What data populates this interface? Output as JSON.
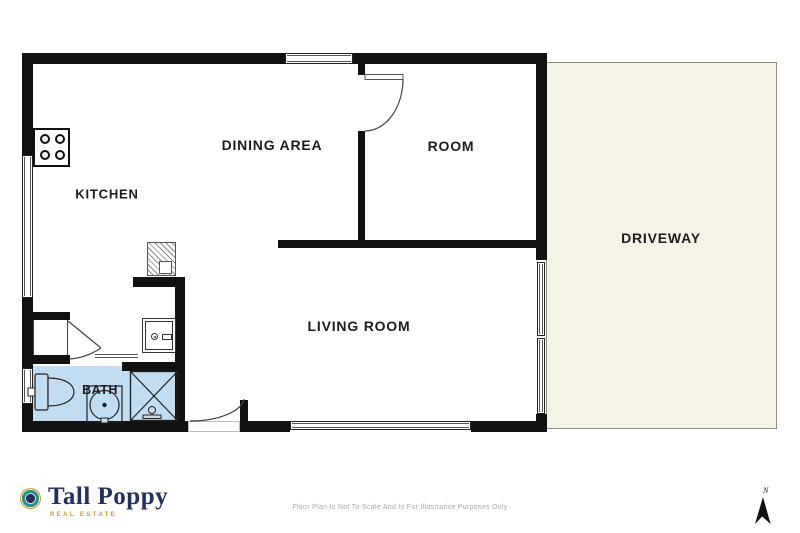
{
  "page": {
    "type": "residential-floor-plan"
  },
  "rooms": {
    "kitchen": "KITCHEN",
    "dining_area": "DINING AREA",
    "room": "ROOM",
    "living_room": "LIVING ROOM",
    "bath": "BATH",
    "driveway": "DRIVEWAY"
  },
  "branding": {
    "name": "Tall Poppy",
    "tagline": "REAL ESTATE"
  },
  "compass": {
    "north": "N"
  },
  "footer": {
    "disclaimer": "Floor Plan Is Not To Scale And Is For Illustrative Purposes Only"
  },
  "colors": {
    "wall": "#111111",
    "bath-fill": "#c2ddf1",
    "driveway-fill": "#f5f3e6",
    "driveway-border": "#8e8e7e",
    "label": "#1c1c1c",
    "brand-navy": "#25305f",
    "brand-gold": "#c79a35",
    "brand-teal": "#2e8f8a",
    "disclaimer": "#a8a8a8"
  },
  "icons": {
    "logo_mark": "tall-poppy-logo-icon",
    "north_arrow": "north-arrow-icon",
    "stove": "stove-icon",
    "hot_water_cylinder": "hot-water-cylinder-icon",
    "washing_machine": "washing-machine-icon",
    "toilet": "toilet-icon",
    "basin": "basin-icon",
    "shower": "shower-icon"
  }
}
